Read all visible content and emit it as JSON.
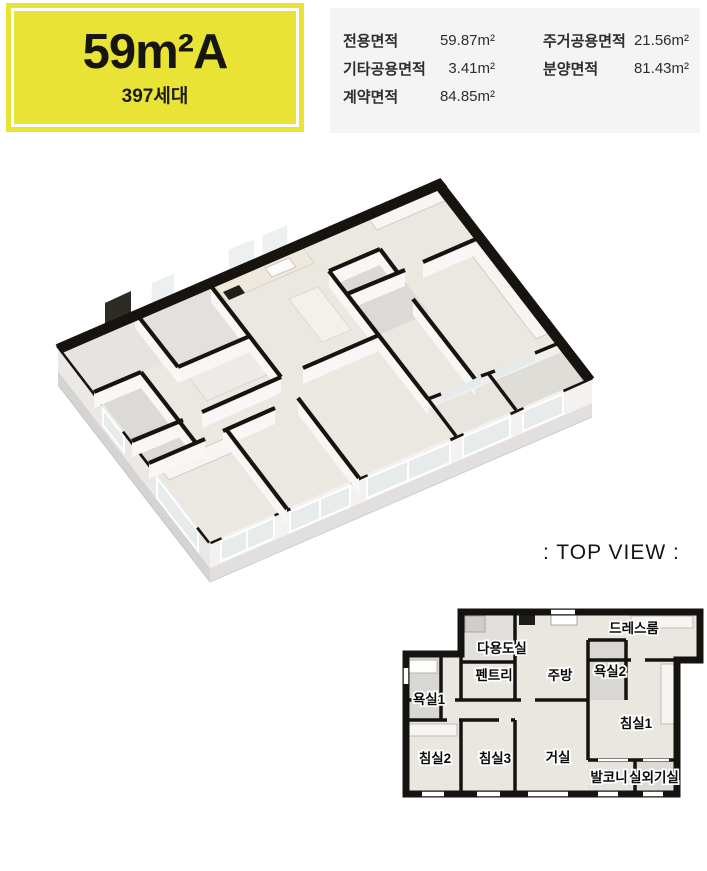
{
  "badge": {
    "size_label": "59m²A",
    "households_label": "397세대",
    "bg_color": "#e8e335"
  },
  "areas": {
    "col1": [
      {
        "label": "전용면적",
        "value": "59.87m²"
      },
      {
        "label": "기타공용면적",
        "value": "3.41m²"
      },
      {
        "label": "계약면적",
        "value": "84.85m²"
      }
    ],
    "col2": [
      {
        "label": "주거공용면적",
        "value": "21.56m²"
      },
      {
        "label": "분양면적",
        "value": "81.43m²"
      }
    ]
  },
  "top_view": {
    "caption": ": TOP VIEW :",
    "rooms": [
      {
        "name": "다용도실"
      },
      {
        "name": "펜트리"
      },
      {
        "name": "주방"
      },
      {
        "name": "욕실2"
      },
      {
        "name": "드레스룸"
      },
      {
        "name": "욕실1"
      },
      {
        "name": "침실1"
      },
      {
        "name": "침실2"
      },
      {
        "name": "침실3"
      },
      {
        "name": "거실"
      },
      {
        "name": "발코니"
      },
      {
        "name": "실외기실"
      }
    ]
  },
  "colors": {
    "badge_yellow": "#e8e335",
    "panel_gray": "#f4f4f4",
    "wall_black": "#17130f",
    "floor_wood": "#ebe8e2"
  }
}
